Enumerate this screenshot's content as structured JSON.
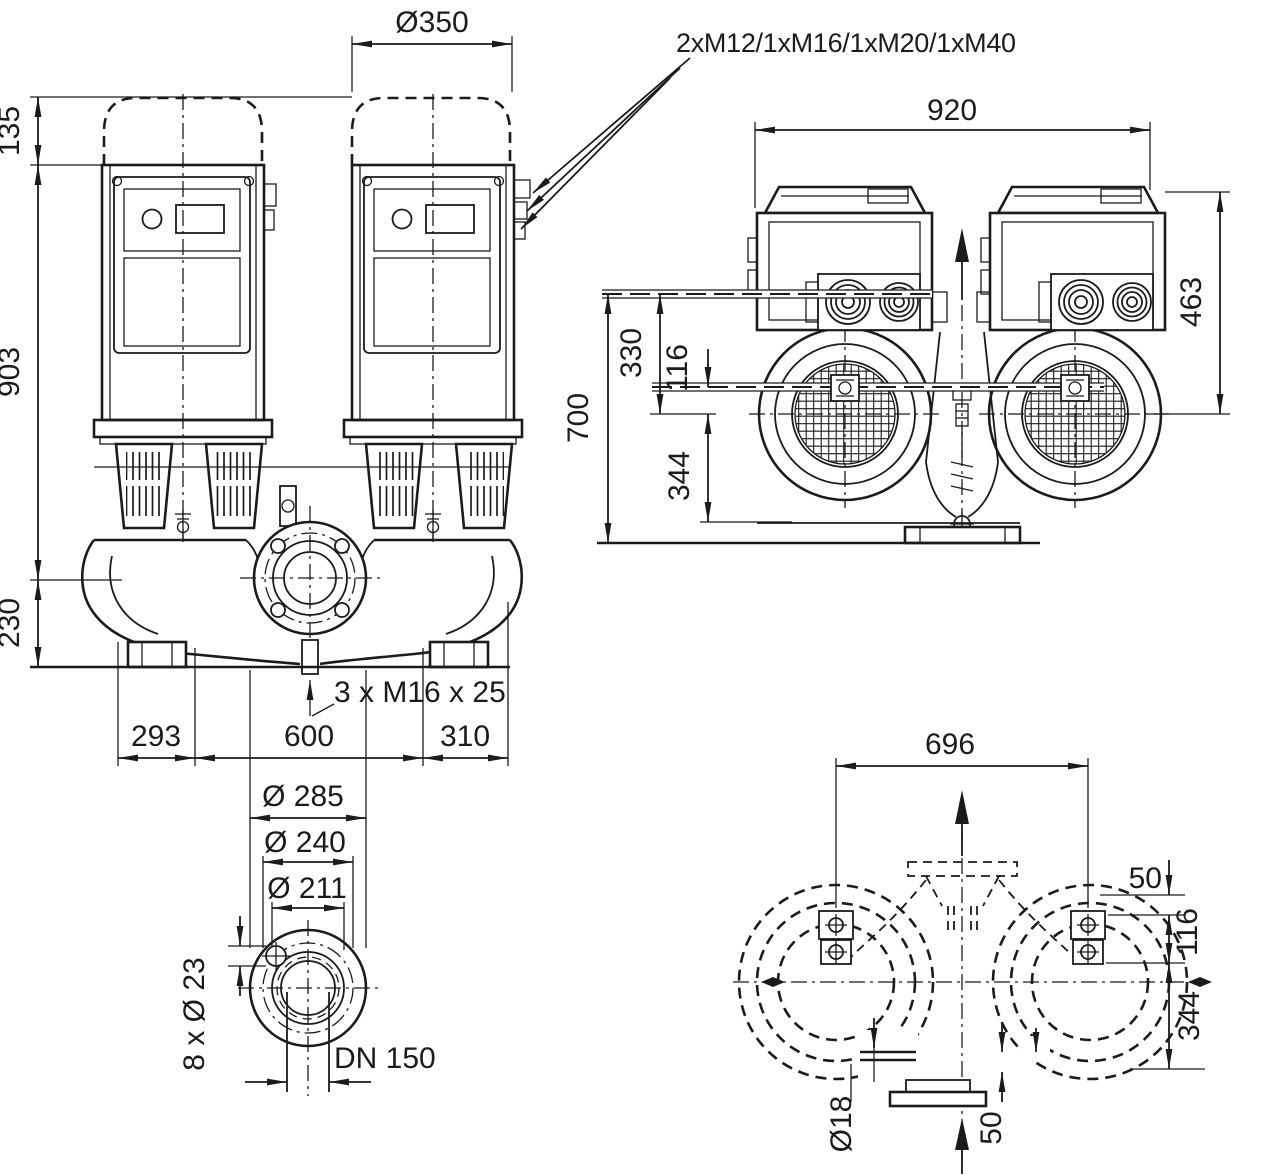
{
  "page": {
    "background": "#ffffff",
    "ink_color": "#1b1b1b"
  },
  "drawing": {
    "type": "pump_dimensional_drawing",
    "views": {
      "front": {
        "cable_gland_label": "2xM12/1xM16/1xM20/1xM40",
        "motor_diameter": "Ø350",
        "cap_height": "135",
        "motor_height": "903",
        "base_height": "230",
        "foot_left": "293",
        "foot_center": "600",
        "foot_right": "310",
        "plug_label": "3 x M16 x 25"
      },
      "top": {
        "width": "920",
        "box_height": "463",
        "overall_height": "700",
        "gland_height": "330",
        "axis_offset": "116",
        "foot_height": "344"
      },
      "flange": {
        "outer_diameter": "Ø 285",
        "bolt_circle": "Ø 240",
        "raised_face": "Ø 211",
        "bolt_holes": "8 x Ø 23",
        "nominal_bore": "DN 150"
      },
      "plan": {
        "width": "696",
        "edge_offset": "50",
        "bolt_spacing": "116",
        "center_to_base": "344",
        "slot_diameter": "Ø18",
        "foot_offset": "50"
      }
    }
  }
}
